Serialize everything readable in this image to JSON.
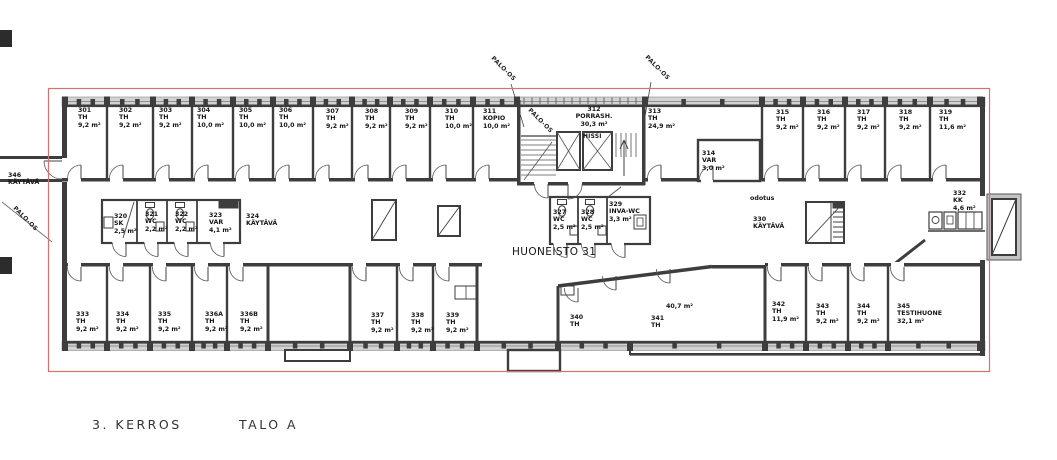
{
  "drawing": {
    "caption": {
      "floor": "3. KERROS",
      "building": "TALO A"
    },
    "labels": {
      "apartment": "HUONEISTO 31",
      "fire_compartment": "PALO-OS",
      "elevator": "HISSI",
      "waiting": "odotus",
      "open_area": "40,7 m²"
    },
    "colors": {
      "boundary_red": "#d4736e",
      "wall_dark": "#3d3d3d",
      "window_gray": "#d2d2d2"
    },
    "rooms": {
      "r301": {
        "number": "301",
        "type": "TH",
        "area": "9,2 m²"
      },
      "r302": {
        "number": "302",
        "type": "TH",
        "area": "9,2 m²"
      },
      "r303": {
        "number": "303",
        "type": "TH",
        "area": "9,2 m²"
      },
      "r304": {
        "number": "304",
        "type": "TH",
        "area": "10,0 m²"
      },
      "r305": {
        "number": "305",
        "type": "TH",
        "area": "10,0 m²"
      },
      "r306": {
        "number": "306",
        "type": "TH",
        "area": "10,0 m²"
      },
      "r307": {
        "number": "307",
        "type": "TH",
        "area": "9,2 m²"
      },
      "r308": {
        "number": "308",
        "type": "TH",
        "area": "9,2 m²"
      },
      "r309": {
        "number": "309",
        "type": "TH",
        "area": "9,2 m²"
      },
      "r310": {
        "number": "310",
        "type": "TH",
        "area": "10,0 m²"
      },
      "r311": {
        "number": "311",
        "type": "KOPIO",
        "area": "10,0 m²"
      },
      "r312": {
        "number": "312",
        "type": "PORRASH.",
        "area": "30,3 m²"
      },
      "r313": {
        "number": "313",
        "type": "TH",
        "area": "24,9 m²"
      },
      "r314": {
        "number": "314",
        "type": "VAR",
        "area": "3,0 m²"
      },
      "r315": {
        "number": "315",
        "type": "TH",
        "area": "9,2 m²"
      },
      "r316": {
        "number": "316",
        "type": "TH",
        "area": "9,2 m²"
      },
      "r317": {
        "number": "317",
        "type": "TH",
        "area": "9,2 m²"
      },
      "r318": {
        "number": "318",
        "type": "TH",
        "area": "9,2 m²"
      },
      "r319": {
        "number": "319",
        "type": "TH",
        "area": "11,6 m²"
      },
      "r320": {
        "number": "320",
        "type": "SK",
        "area": "2,5 m²"
      },
      "r321": {
        "number": "321",
        "type": "WC",
        "area": "2,2 m²"
      },
      "r322": {
        "number": "322",
        "type": "WC",
        "area": "2,2 m²"
      },
      "r323": {
        "number": "323",
        "type": "VAR",
        "area": "4,1 m²"
      },
      "r324": {
        "number": "324",
        "type": "KÄYTÄVÄ"
      },
      "r327": {
        "number": "327",
        "type": "WC",
        "area": "2,5 m²"
      },
      "r328": {
        "number": "328",
        "type": "WC",
        "area": "2,5 m²"
      },
      "r329": {
        "number": "329",
        "type": "INVA-WC",
        "area": "3,3 m²"
      },
      "r330": {
        "number": "330",
        "type": "KÄYTÄVÄ"
      },
      "r332": {
        "number": "332",
        "type": "KK",
        "area": "4,6 m²"
      },
      "r333": {
        "number": "333",
        "type": "TH",
        "area": "9,2 m²"
      },
      "r334": {
        "number": "334",
        "type": "TH",
        "area": "9,2 m²"
      },
      "r335": {
        "number": "335",
        "type": "TH",
        "area": "9,2 m²"
      },
      "r336a": {
        "number": "336A",
        "type": "TH",
        "area": "9,2 m²"
      },
      "r336b": {
        "number": "336B",
        "type": "TH",
        "area": "9,2 m²"
      },
      "r337": {
        "number": "337",
        "type": "TH",
        "area": "9,2 m²"
      },
      "r338": {
        "number": "338",
        "type": "TH",
        "area": "9,2 m²"
      },
      "r339": {
        "number": "339",
        "type": "TH",
        "area": "9,2 m²"
      },
      "r340": {
        "number": "340",
        "type": "TH"
      },
      "r341": {
        "number": "341",
        "type": "TH"
      },
      "r342": {
        "number": "342",
        "type": "TH",
        "area": "11,9 m²"
      },
      "r343": {
        "number": "343",
        "type": "TH",
        "area": "9,2 m²"
      },
      "r344": {
        "number": "344",
        "type": "TH",
        "area": "9,2 m²"
      },
      "r345": {
        "number": "345",
        "type": "TESTIHUONE",
        "area": "32,1 m²"
      },
      "r346": {
        "number": "346",
        "type": "KÄYTÄVÄ"
      }
    }
  }
}
